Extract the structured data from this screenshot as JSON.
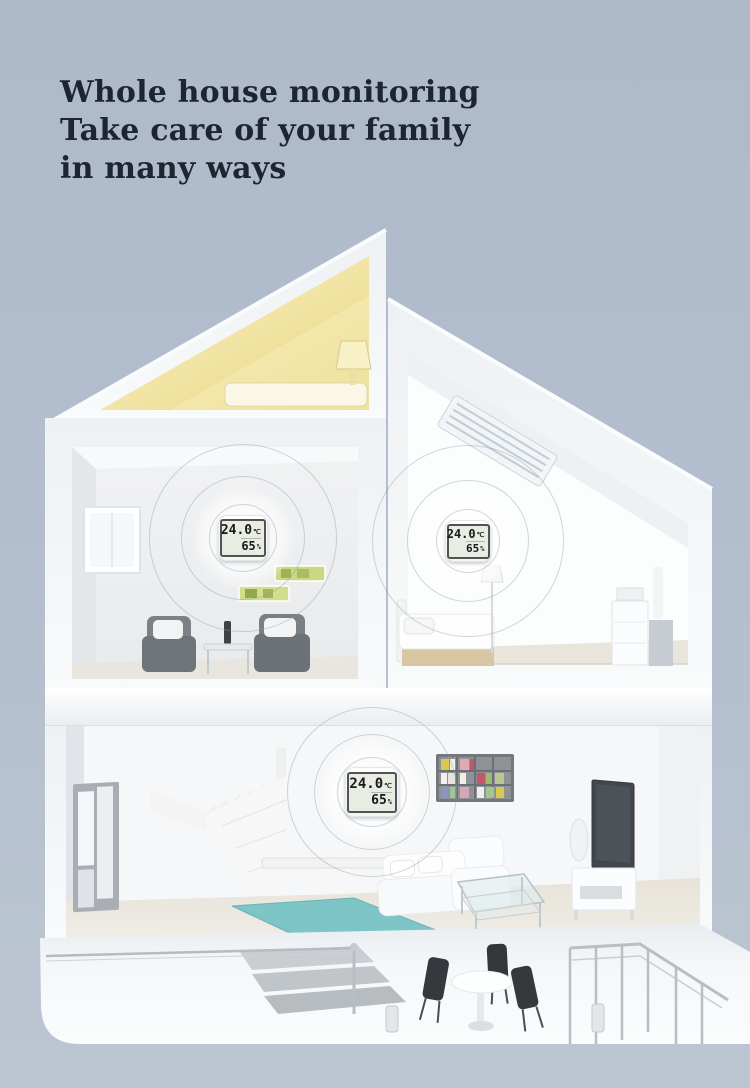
{
  "title": {
    "line1": "Whole house monitoring",
    "line2": "Take care of your family",
    "line3": "in many ways"
  },
  "devices": [
    {
      "room": "study-room",
      "temperature": "24.0",
      "temperature_unit": "℃",
      "humidity": "65",
      "humidity_unit": "%"
    },
    {
      "room": "attic-bedroom",
      "temperature": "24.0",
      "temperature_unit": "℃",
      "humidity": "65",
      "humidity_unit": "%"
    },
    {
      "room": "living-room",
      "temperature": "24.0",
      "temperature_unit": "℃",
      "humidity": "65",
      "humidity_unit": "%"
    }
  ],
  "colors": {
    "background": "#b3bfce",
    "title_text": "#1d2531",
    "house_white": "#f4f6f8",
    "attic_glow": "#ecd98e",
    "rug_teal": "#7dc5c6",
    "lcd_background": "#e9ece2",
    "lcd_digits": "#17191b"
  }
}
